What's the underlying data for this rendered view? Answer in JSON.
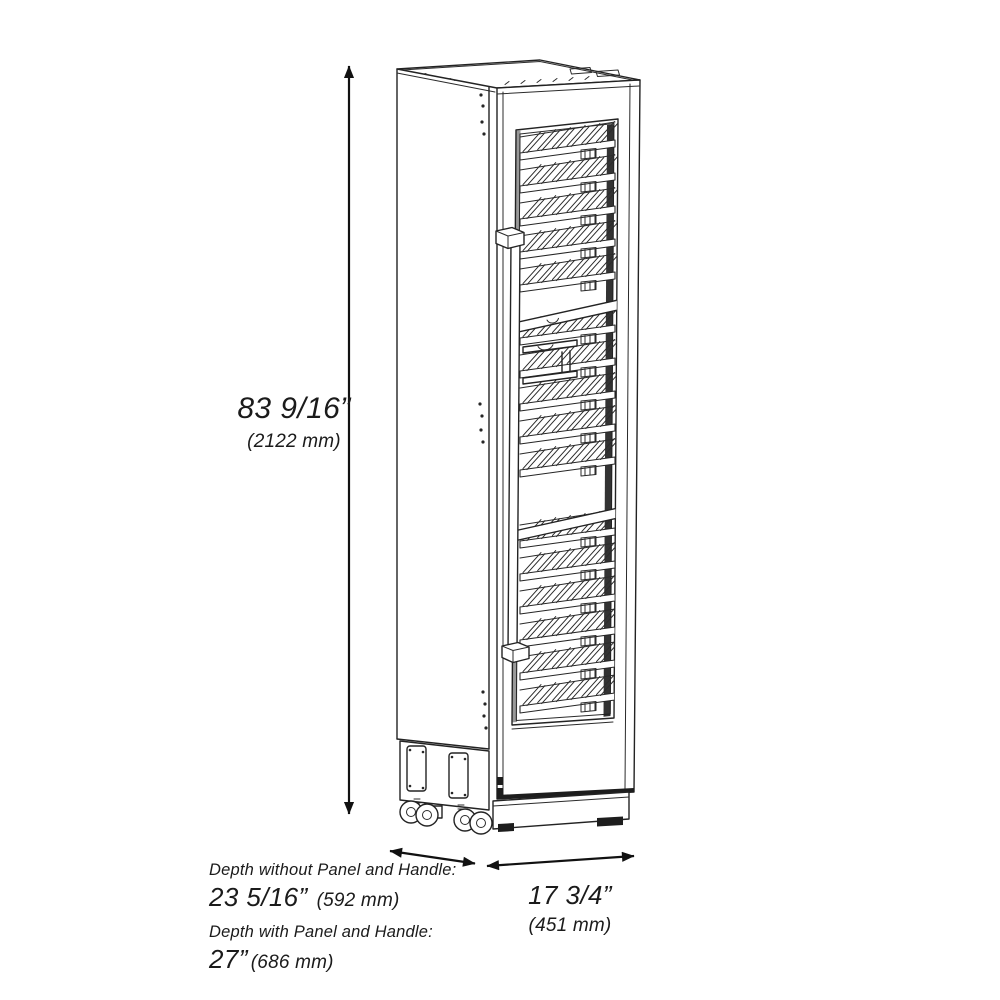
{
  "diagram": {
    "line_color": "#232323",
    "background": "#ffffff",
    "height_dimension": {
      "value": "83 9/16”",
      "metric": "(2122 mm)"
    },
    "depth_without_panel": {
      "label": "Depth without Panel and Handle:",
      "value": "23 5/16”",
      "metric": "(592 mm)"
    },
    "depth_with_panel": {
      "label": "Depth with Panel and Handle:",
      "value": "27”",
      "metric": "(686 mm)"
    },
    "width_dimension": {
      "value": "17 3/4”",
      "metric": "(451 mm)"
    }
  }
}
